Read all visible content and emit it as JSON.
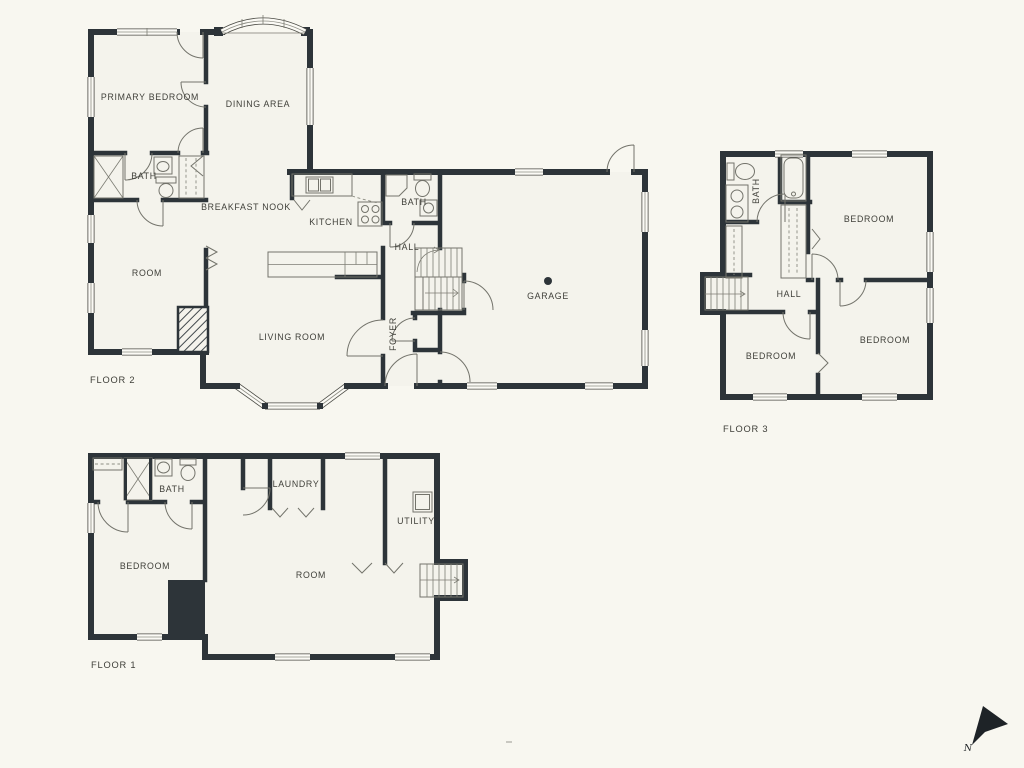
{
  "page": {
    "background": "#f8f7f0",
    "wall_color": "#2d3439"
  },
  "floor2": {
    "label": "FLOOR 2",
    "rooms": {
      "primary_bedroom": "PRIMARY BEDROOM",
      "dining_area": "DINING AREA",
      "bath": "BATH",
      "breakfast_nook": "BREAKFAST NOOK",
      "kitchen": "KITCHEN",
      "bath2": "BATH",
      "hall": "HALL",
      "room": "ROOM",
      "living_room": "LIVING ROOM",
      "foyer": "FOYER",
      "garage": "GARAGE"
    }
  },
  "floor3": {
    "label": "FLOOR 3",
    "rooms": {
      "bath": "BATH",
      "bedroom_top": "BEDROOM",
      "hall": "HALL",
      "bedroom_left": "BEDROOM",
      "bedroom_right": "BEDROOM"
    }
  },
  "floor1": {
    "label": "FLOOR 1",
    "rooms": {
      "bath": "BATH",
      "laundry": "LAUNDRY",
      "bedroom": "BEDROOM",
      "room": "ROOM",
      "utility": "UTILITY"
    }
  },
  "compass": {
    "north_label": "N"
  }
}
